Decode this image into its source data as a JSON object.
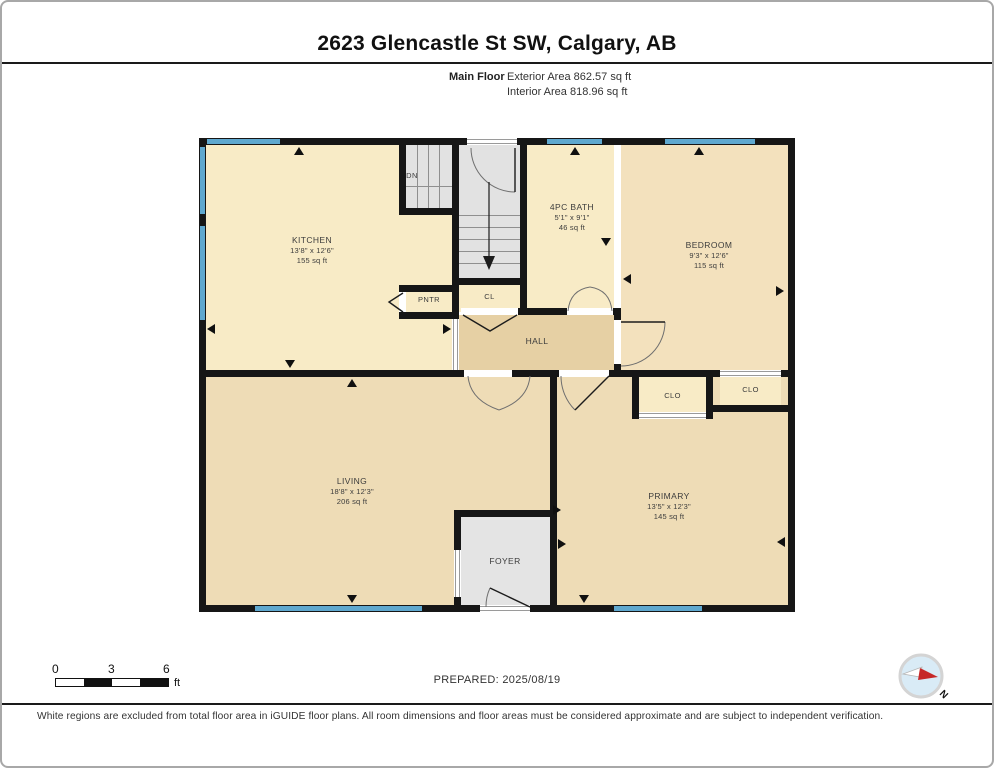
{
  "header": {
    "title": "2623 Glencastle St SW, Calgary, AB",
    "floor_label": "Main Floor",
    "exterior_area": "Exterior Area 862.57 sq ft",
    "interior_area": "Interior Area 818.96 sq ft"
  },
  "rooms": {
    "kitchen": {
      "name": "KITCHEN",
      "dims": "13'8\" x 12'6\"",
      "area": "155 sq ft"
    },
    "bath": {
      "name": "4PC BATH",
      "dims": "5'1\" x 9'1\"",
      "area": "46 sq ft"
    },
    "bedroom": {
      "name": "BEDROOM",
      "dims": "9'3\" x 12'6\"",
      "area": "115 sq ft"
    },
    "living": {
      "name": "LIVING",
      "dims": "18'8\" x 12'3\"",
      "area": "206 sq ft"
    },
    "primary": {
      "name": "PRIMARY",
      "dims": "13'5\" x 12'3\"",
      "area": "145 sq ft"
    },
    "hall": {
      "name": "HALL"
    },
    "foyer": {
      "name": "FOYER"
    },
    "closet_hall": {
      "name": "CL"
    },
    "pantry": {
      "name": "PNTR"
    },
    "closet_primary": {
      "name": "CLO"
    },
    "closet_bedroom": {
      "name": "CLO"
    },
    "stairs": {
      "label": "DN"
    }
  },
  "scale_bar": {
    "ticks": [
      "0",
      "3",
      "6"
    ],
    "unit": "ft"
  },
  "prepared": "PREPARED: 2025/08/19",
  "compass": {
    "north_label": "N"
  },
  "footer": {
    "disclaimer": "White regions are excluded from total floor area in iGUIDE floor plans. All room dimensions and floor areas must be considered approximate and are subject to independent verification."
  },
  "colors": {
    "wall": "#161616",
    "window": "#5fa8cf",
    "room_cream": "#f8ebc6",
    "room_tan": "#eedcb6",
    "bedroom_tan": "#f3e1bd",
    "hall_tan": "#e6d0a4",
    "stairs_gray": "#e2e2e2",
    "compass_blue": "#d9ebf6",
    "compass_red": "#c62828"
  }
}
